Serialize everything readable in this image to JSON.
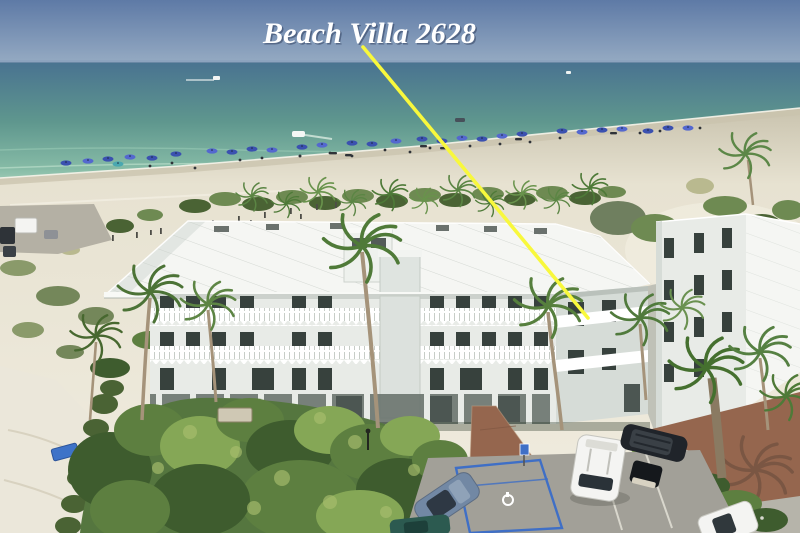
{
  "meta": {
    "type": "aerial-photograph",
    "subject": "Beachfront condominium complex on a white-sand gulf beach with turquoise water",
    "width_px": 800,
    "height_px": 533
  },
  "annotation": {
    "label": "Beach Villa 2628",
    "label_color": "#ffffff",
    "line_color": "#f8f83c",
    "line": {
      "x1": 363,
      "y1": 47,
      "x2": 588,
      "y2": 318
    }
  },
  "colors": {
    "sky_top": "#5e7aa6",
    "sky_horizon": "#96abc3",
    "sea_deep": "#497390",
    "sea_mid": "#5f978e",
    "sea_shallow": "#86bba6",
    "sea_shore": "#b7dcc6",
    "sand_wet": "#c9c3ae",
    "sand": "#e7e2d1",
    "sand_bright": "#f0ecdf",
    "scrub": "#6e8a52",
    "scrub_dark": "#4a6334",
    "grass_dry": "#b9b98f",
    "veg_dark": "#3e5c2e",
    "veg_mid": "#5d7f40",
    "veg_light": "#85a756",
    "veg_highlight": "#a9bf6e",
    "palm": "#4e7a38",
    "palm_light": "#69934c",
    "trunk": "#a5937a",
    "roof": "#f5f6f3",
    "roof_seam": "#c9cfc9",
    "roof_shade": "#e2e6e2",
    "wall": "#e8ebe7",
    "wall_shade": "#d6dcd7",
    "window": "#37413d",
    "opening": "#4c5652",
    "railing": "#ffffff",
    "vent": "#6a716d",
    "asphalt": "#a2a098",
    "stall_line": "#d9d7cd",
    "handicap_blue": "#3f6fc6",
    "brick": "#95664e",
    "concrete": "#b6b4aa",
    "umbrella": "#3b51b0",
    "umbrella2": "#5468cf",
    "vehicle_dark": "#20242a",
    "vehicle_white": "#f4f4f2",
    "vehicle_blue": "#7288a4",
    "vehicle_teal": "#2c5a50",
    "line_yellow": "#f8f83c",
    "label": "#ffffff"
  },
  "scene": {
    "elements": [
      "sky",
      "ocean",
      "boats",
      "beach",
      "beach-umbrellas",
      "dune-vegetation",
      "beach-parking",
      "main-condo-building",
      "right-wing",
      "neighbor-building",
      "palm-trees",
      "garden",
      "brick-path",
      "brick-plaza",
      "parking-lot",
      "handicap-space"
    ],
    "vehicles": [
      "white-minivan",
      "black-suv",
      "golf-cart",
      "blue-sedan",
      "teal-car",
      "white-car",
      "beach-van"
    ],
    "building": {
      "roof": "white standing-seam metal",
      "balconies": "white picket railings with scalloped trim",
      "stories": 4
    }
  }
}
